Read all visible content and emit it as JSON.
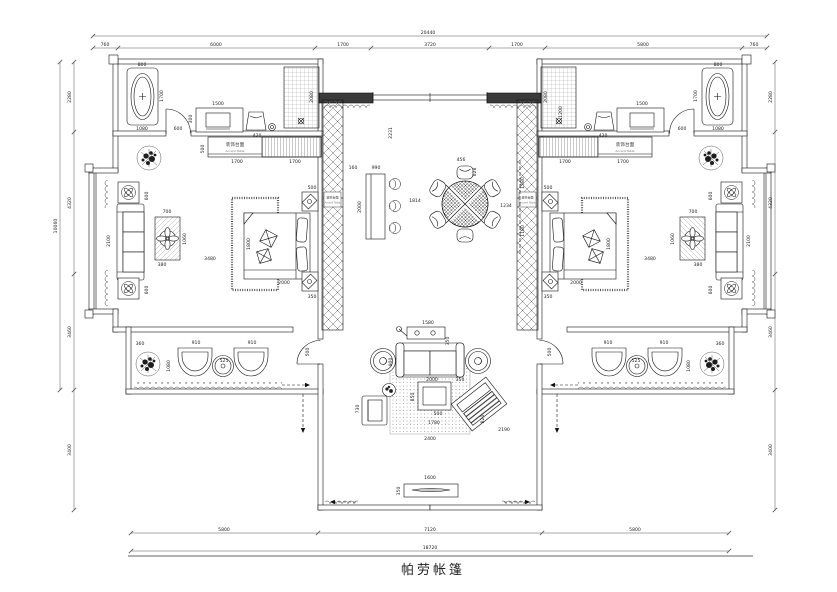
{
  "title": {
    "text": "帕劳帐篷"
  },
  "notes": {
    "accent_zh": "装饰台面",
    "accent_en": "Accent Table"
  },
  "dims": {
    "t_total": "20440",
    "t1": "760",
    "t2": "6000",
    "t3": "1700",
    "t4": "3720",
    "t5": "1700",
    "t6": "5800",
    "t7": "760",
    "b1": "5800",
    "b2": "7120",
    "b3": "5800",
    "b_total": "18720",
    "l1": "2280",
    "l2": "4320",
    "l3": "3460",
    "l4": "3400",
    "l_total": "10060",
    "r1": "2280",
    "r2": "4320",
    "r3": "3460",
    "r4": "3400",
    "lb_tub_w": "800",
    "lb_tub_h": "1700",
    "lb_tub_b": "1080",
    "lb_van_w": "1500",
    "lb_van_d": "300",
    "lb_stool": "420",
    "lb_gap": "600",
    "lb_shower": "2080",
    "lb_cab_d": "500",
    "lb_cab1": "1700",
    "lb_cab2": "1700",
    "lr_tbl_w": "700",
    "lr_tbl_h": "1060",
    "lr_tbl_b": "380",
    "lr_gap": "3480",
    "lr_bed_w": "1800",
    "lr_bed_l": "2000",
    "lr_ns1": "500",
    "lr_ns2": "350",
    "lw_t1": "600",
    "lw_sofa": "2100",
    "lw_t2": "600",
    "ll_plant": "360",
    "ll_c1": "910",
    "ll_c2": "910",
    "ll_tbl": "525",
    "ll_ch": "1080",
    "ll_door": "500",
    "c_v": "2231",
    "c_160": "160",
    "c_bar": "990",
    "c_bar_l": "2000",
    "c_1814": "1814",
    "c_456": "456",
    "c_628": "628",
    "c_1234": "1234",
    "c_1580": "1580",
    "c_1180": "1180",
    "lv_console": "1580",
    "lv_350a": "350",
    "lv_depth": "900",
    "lv_2000": "2000",
    "lv_350b": "350",
    "lv_850": "850",
    "lv_500": "500",
    "lv_1780": "1780",
    "lv_730": "730",
    "lv_820": "820",
    "lv_2190": "2190",
    "lv_2400": "2400",
    "lv_cons2": "1600",
    "lv_cons_d": "350",
    "rb_tub_w": "800",
    "rb_tub_h": "1700",
    "rb_tub_b": "1080",
    "rb_van_w": "1500",
    "rb_stool": "420",
    "rb_gap": "600",
    "rb_shower": "2080",
    "rb_plant": "1200",
    "rb_cab1": "1700",
    "rb_cab2": "1700",
    "rr_tbl_w": "700",
    "rr_tbl_h": "1060",
    "rr_tbl_b": "380",
    "rr_gap": "3480",
    "rr_bed_w": "1800",
    "rr_bed_l": "2000",
    "rr_ns1": "500",
    "rr_ns2": "350",
    "rw_t1": "600",
    "rw_sofa": "2100",
    "rw_t2": "600",
    "rl_plant": "360",
    "rl_c1": "910",
    "rl_c2": "910",
    "rl_tbl": "525",
    "rl_ch": "1080",
    "rl_door": "500"
  }
}
